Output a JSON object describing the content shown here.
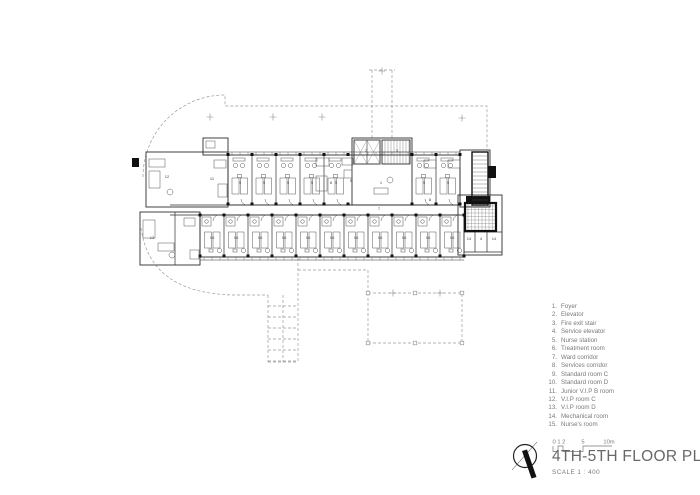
{
  "colors": {
    "ink": "#2e2e2e",
    "furniture": "#555555",
    "dashed": "#9a9a9a",
    "muted_text": "#7a7a7a",
    "title_text": "#686868",
    "black_fill": "#111111",
    "paper": "#ffffff"
  },
  "legend": {
    "items": [
      {
        "num": "1.",
        "label": "Foyer"
      },
      {
        "num": "2.",
        "label": "Elevator"
      },
      {
        "num": "3.",
        "label": "Fire exit stair"
      },
      {
        "num": "4.",
        "label": "Service elevator"
      },
      {
        "num": "5.",
        "label": "Nurse station"
      },
      {
        "num": "6.",
        "label": "Treatment room"
      },
      {
        "num": "7.",
        "label": "Ward corridor"
      },
      {
        "num": "8.",
        "label": "Services corridor"
      },
      {
        "num": "9.",
        "label": "Standard room C"
      },
      {
        "num": "10.",
        "label": "Standard room D"
      },
      {
        "num": "11.",
        "label": "Junior V.I.P B room"
      },
      {
        "num": "12.",
        "label": "V.I.P room C"
      },
      {
        "num": "13.",
        "label": "V.I.P room D"
      },
      {
        "num": "14.",
        "label": "Mechanical room"
      },
      {
        "num": "15.",
        "label": "Nurse's room"
      }
    ]
  },
  "title_block": {
    "title": "4TH-5TH FLOOR PLAN",
    "scale_label": "SCALE 1 : 400",
    "scalebar_labels": [
      "0 1 2",
      "5",
      "10m"
    ]
  },
  "plan": {
    "room_labels": [
      {
        "t": "12",
        "x": 167,
        "y": 178
      },
      {
        "t": "11",
        "x": 212,
        "y": 180
      },
      {
        "t": "13",
        "x": 152,
        "y": 239
      },
      {
        "t": "9",
        "x": 240,
        "y": 184
      },
      {
        "t": "9",
        "x": 264,
        "y": 184
      },
      {
        "t": "9",
        "x": 288,
        "y": 184
      },
      {
        "t": "9",
        "x": 312,
        "y": 184
      },
      {
        "t": "9",
        "x": 336,
        "y": 184
      },
      {
        "t": "9",
        "x": 424,
        "y": 184
      },
      {
        "t": "9",
        "x": 448,
        "y": 184
      },
      {
        "t": "10",
        "x": 212,
        "y": 239
      },
      {
        "t": "10",
        "x": 236,
        "y": 239
      },
      {
        "t": "10",
        "x": 260,
        "y": 239
      },
      {
        "t": "10",
        "x": 284,
        "y": 239
      },
      {
        "t": "10",
        "x": 308,
        "y": 239
      },
      {
        "t": "10",
        "x": 332,
        "y": 239
      },
      {
        "t": "10",
        "x": 356,
        "y": 239
      },
      {
        "t": "10",
        "x": 380,
        "y": 239
      },
      {
        "t": "10",
        "x": 404,
        "y": 239
      },
      {
        "t": "10",
        "x": 428,
        "y": 239
      },
      {
        "t": "10",
        "x": 452,
        "y": 239
      },
      {
        "t": "7",
        "x": 379,
        "y": 210
      },
      {
        "t": "8",
        "x": 430,
        "y": 201
      },
      {
        "t": "5",
        "x": 351,
        "y": 182
      },
      {
        "t": "6",
        "x": 331,
        "y": 184
      },
      {
        "t": "1",
        "x": 381,
        "y": 184
      },
      {
        "t": "2",
        "x": 366,
        "y": 152
      },
      {
        "t": "3",
        "x": 397,
        "y": 152
      },
      {
        "t": "14",
        "x": 469,
        "y": 240
      },
      {
        "t": "4",
        "x": 481,
        "y": 240
      },
      {
        "t": "14",
        "x": 494,
        "y": 240
      }
    ]
  }
}
